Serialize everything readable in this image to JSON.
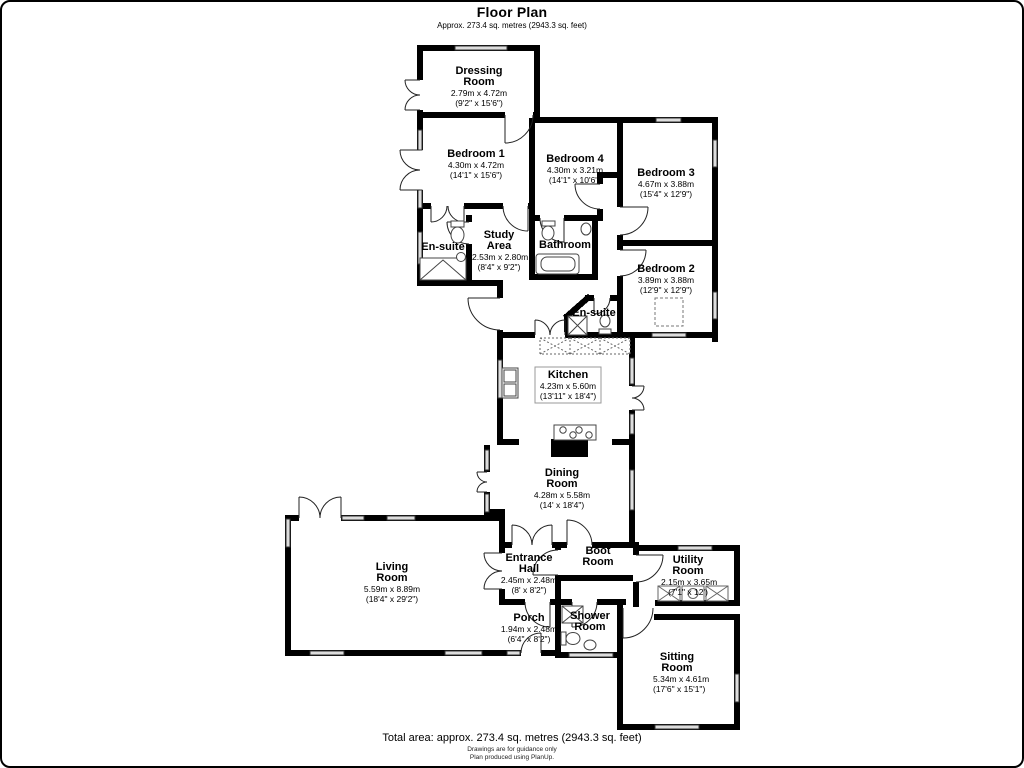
{
  "header": {
    "title": "Floor Plan",
    "subtitle": "Approx. 273.4 sq. metres (2943.3 sq. feet)"
  },
  "rooms": {
    "dressing": {
      "name": "Dressing Room",
      "metric": "2.79m x 4.72m",
      "imperial": "(9'2\" x 15'6\")"
    },
    "bedroom1": {
      "name": "Bedroom 1",
      "metric": "4.30m x 4.72m",
      "imperial": "(14'1\" x 15'6\")"
    },
    "bedroom4": {
      "name": "Bedroom 4",
      "metric": "4.30m x 3.21m",
      "imperial": "(14'1\" x 10'6\")"
    },
    "bedroom3": {
      "name": "Bedroom 3",
      "metric": "4.67m x 3.88m",
      "imperial": "(15'4\" x 12'9\")"
    },
    "ensuite1": {
      "name": "En-suite"
    },
    "study": {
      "name": "Study Area",
      "metric": "2.53m x 2.80m",
      "imperial": "(8'4\" x 9'2\")"
    },
    "bathroom": {
      "name": "Bathroom"
    },
    "bedroom2": {
      "name": "Bedroom 2",
      "metric": "3.89m x 3.88m",
      "imperial": "(12'9\" x 12'9\")"
    },
    "ensuite2": {
      "name": "En-suite"
    },
    "kitchen": {
      "name": "Kitchen",
      "metric": "4.23m x 5.60m",
      "imperial": "(13'11\" x 18'4\")"
    },
    "dining": {
      "name": "Dining Room",
      "metric": "4.28m x 5.58m",
      "imperial": "(14' x 18'4\")"
    },
    "living": {
      "name": "Living Room",
      "metric": "5.59m x 8.89m",
      "imperial": "(18'4\" x 29'2\")"
    },
    "entrance": {
      "name": "Entrance Hall",
      "metric": "2.45m x 2.48m",
      "imperial": "(8' x 8'2\")"
    },
    "porch": {
      "name": "Porch",
      "metric": "1.94m x 2.48m",
      "imperial": "(6'4\" x 8'2\")"
    },
    "boot": {
      "name": "Boot Room"
    },
    "utility": {
      "name": "Utility Room",
      "metric": "2.15m x 3.65m",
      "imperial": "(7'1\" x 12')"
    },
    "shower": {
      "name": "Shower Room"
    },
    "sitting": {
      "name": "Sitting Room",
      "metric": "5.34m x 4.61m",
      "imperial": "(17'6\" x 15'1\")"
    }
  },
  "footer": {
    "total": "Total area: approx. 273.4 sq. metres (2943.3 sq. feet)",
    "note1": "Drawings are for guidance only",
    "note2": "Plan produced using PlanUp."
  },
  "colors": {
    "wall": "#000000",
    "window_fill": "#dddddd",
    "fixture_stroke": "#444444"
  }
}
